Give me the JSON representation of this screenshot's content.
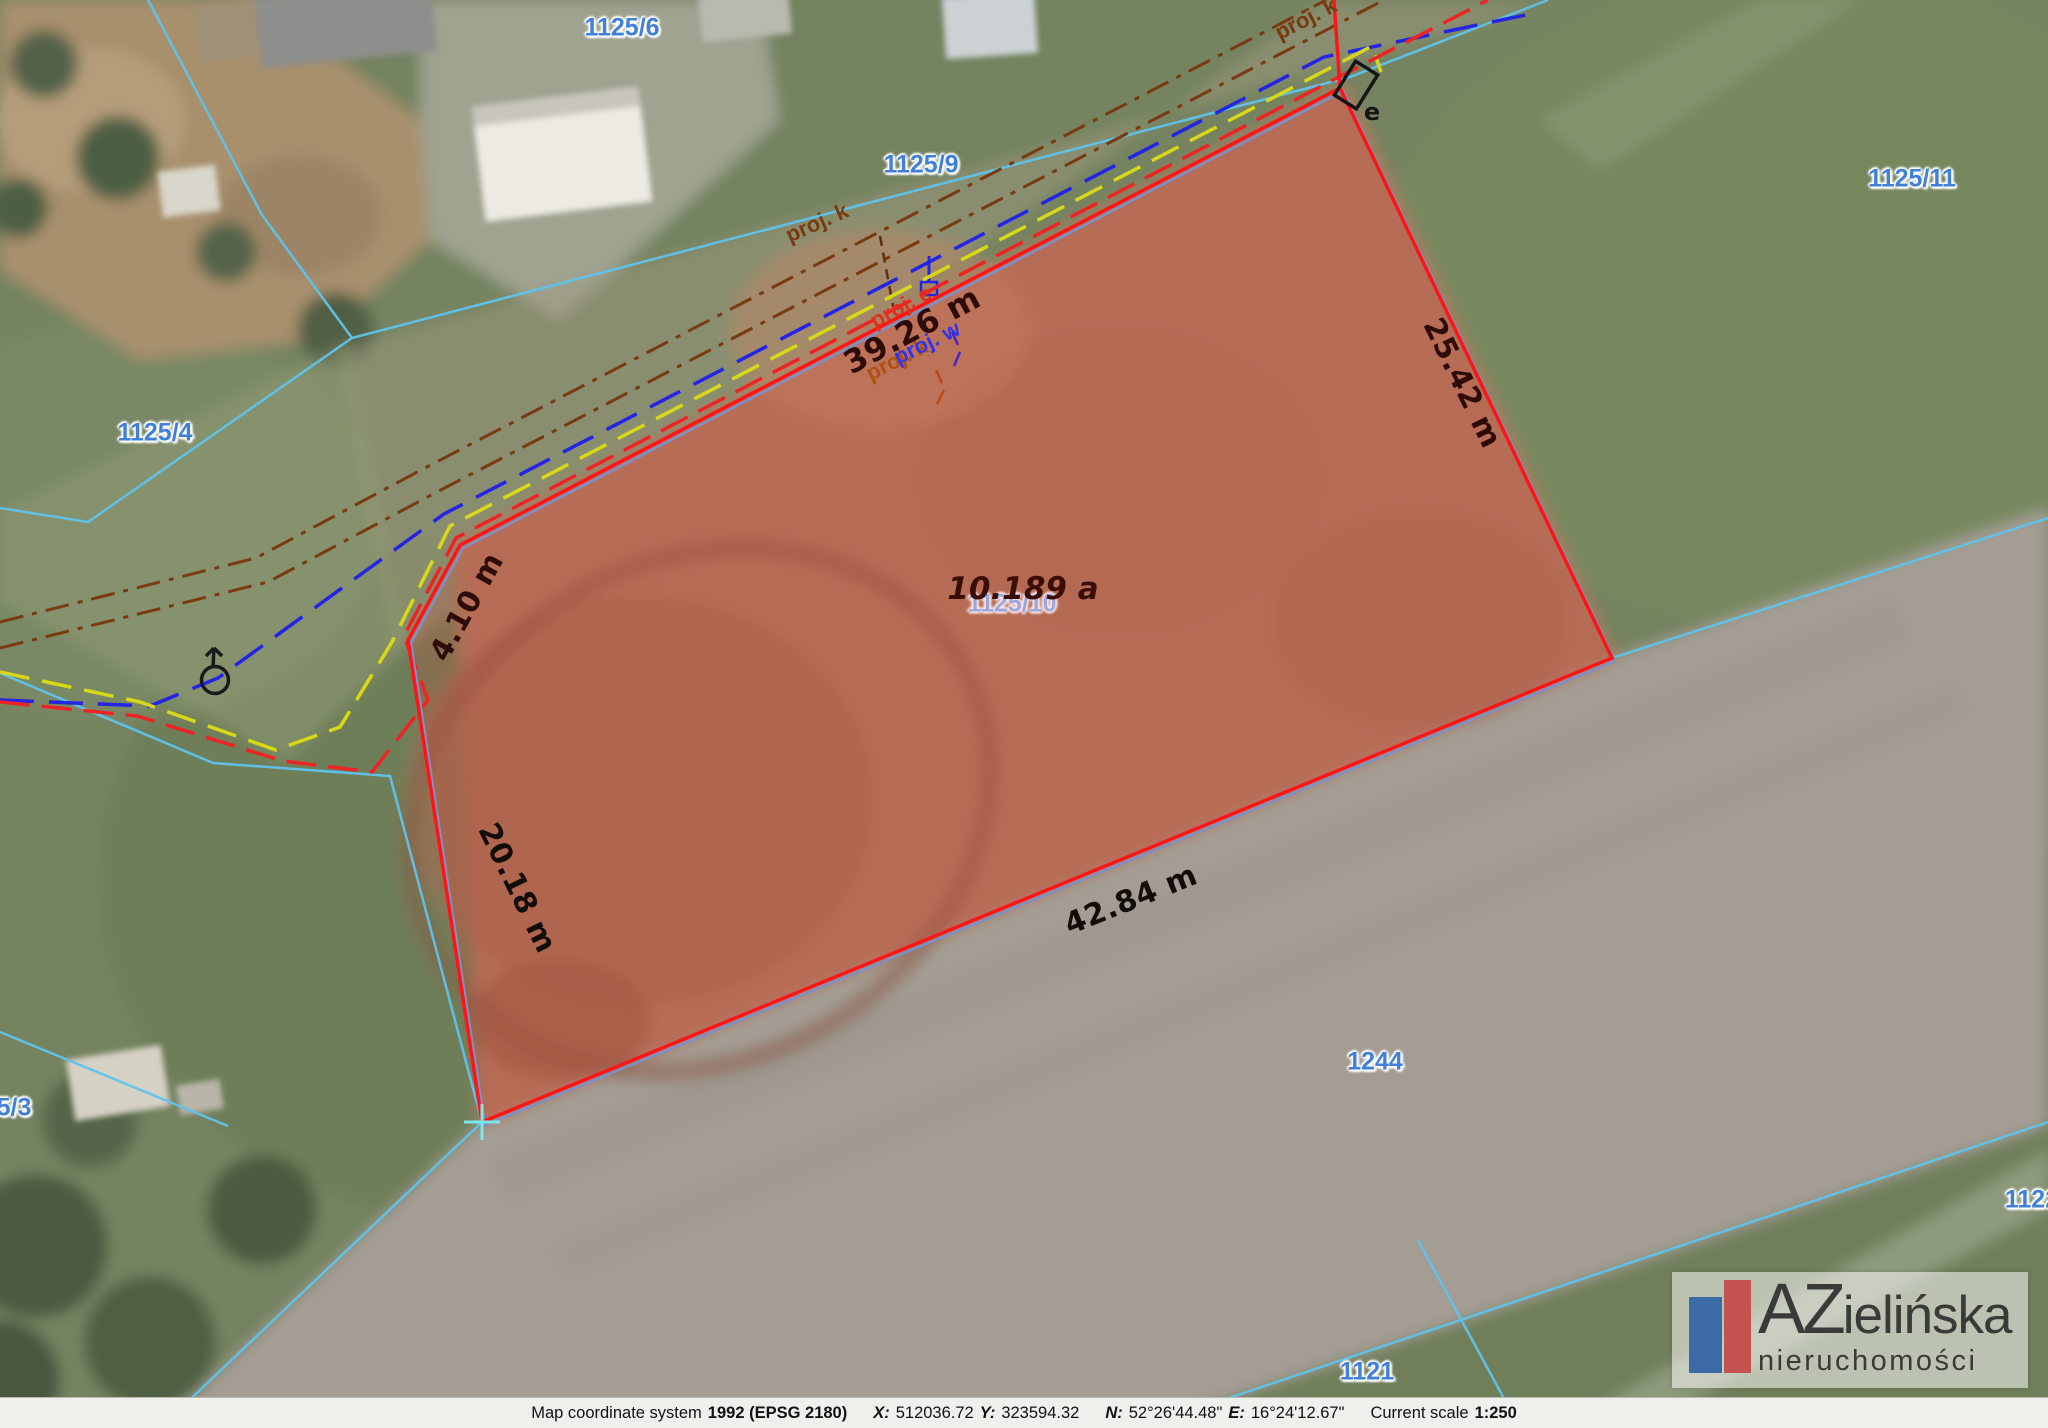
{
  "colors": {
    "parcel_boundary_red": "#ff1515",
    "parcel_fill": "rgba(255,40,40,0.17)",
    "cadastral_cyan": "#5fc3ec",
    "parcel_number_blue": "#4080d8",
    "utility_brown": "#7a3a10",
    "utility_blue": "#2424e4",
    "utility_yellow": "#d8d818",
    "utility_red": "#ee2424",
    "measurement_dark": "#2e0b06",
    "logo_blue": "#3c6aa6",
    "logo_red": "#c4524e"
  },
  "map": {
    "parcels": [
      {
        "label": "1125/6"
      },
      {
        "label": "1125/9"
      },
      {
        "label": "1125/11"
      },
      {
        "label": "1125/4"
      },
      {
        "label": "1125/10"
      },
      {
        "label": "1244"
      },
      {
        "label": "1121"
      },
      {
        "label": "1122"
      },
      {
        "label": "5/3"
      }
    ],
    "measurements": [
      {
        "label": "39.26 m"
      },
      {
        "label": "25.42 m"
      },
      {
        "label": "4.10 m"
      },
      {
        "label": "20.18 m"
      },
      {
        "label": "42.84 m"
      }
    ],
    "area_label": "10.189 a",
    "utility_labels": [
      {
        "label": "proj. k"
      },
      {
        "label": "proj. e"
      },
      {
        "label": "proj. w"
      },
      {
        "label": "proj. k"
      },
      {
        "label": "proj. k"
      }
    ],
    "symbol_labels": {
      "electric_box": "e"
    }
  },
  "logo": {
    "name_initials": "AZ",
    "name_rest": "ielińska",
    "subtitle": "nieruchomości"
  },
  "status_bar": {
    "coord_system_label": "Map coordinate system",
    "coord_system_value": "1992 (EPSG 2180)",
    "x_label": "X:",
    "x_value": "512036.72",
    "y_label": "Y:",
    "y_value": "323594.32",
    "n_label": "N:",
    "n_value": "52°26'44.48\"",
    "e_label": "E:",
    "e_value": "16°24'12.67\"",
    "scale_label": "Current scale",
    "scale_value": "1:250"
  }
}
